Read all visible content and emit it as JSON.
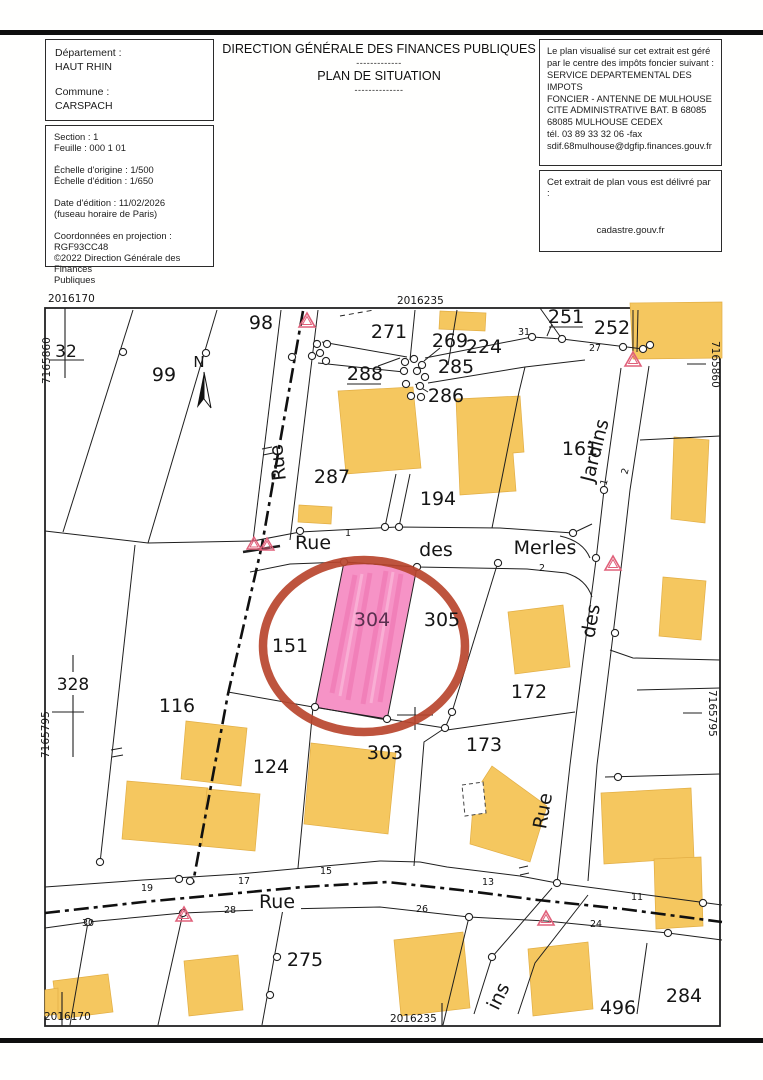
{
  "header": {
    "box1": {
      "lines": [
        "Département :",
        "HAUT RHIN",
        "",
        "Commune :",
        "CARSPACH"
      ]
    },
    "title": {
      "line1": "DIRECTION GÉNÉRALE DES FINANCES PUBLIQUES",
      "sep1": "-------------",
      "line2": "PLAN DE SITUATION",
      "sep2": "--------------"
    },
    "box2": {
      "lines": [
        "Section : 1",
        "Feuille : 000 1 01",
        "",
        "Échelle d'origine : 1/500",
        "Échelle d'édition : 1/650",
        "",
        "Date d'édition : 11/02/2026",
        "(fuseau horaire de Paris)",
        "",
        "Coordonnées en projection : RGF93CC48",
        "©2022 Direction Générale des Finances",
        "Publiques"
      ]
    },
    "box3": {
      "lines": [
        "Le plan visualisé sur cet extrait est géré",
        "par le centre des impôts foncier suivant :",
        "SERVICE DEPARTEMENTAL DES",
        "IMPOTS",
        " FONCIER - ANTENNE DE MULHOUSE",
        "CITE ADMINISTRATIVE   BAT. B 68085",
        "68085    MULHOUSE CEDEX",
        "tél.   03 89 33 32 06 -fax",
        "sdif.68mulhouse@dgfip.finances.gouv.fr"
      ]
    },
    "box4": {
      "title": "Cet extrait de plan vous est délivré par :",
      "site": "cadastre.gouv.fr"
    }
  },
  "map": {
    "corner_coords": {
      "top_left": "2016170",
      "top_center": "2016235",
      "bottom_left": "2016170",
      "bottom_center": "2016235",
      "left_top": "7165860",
      "left_bottom": "7165795",
      "right_top": "7165860",
      "right_bottom": "7165795"
    },
    "north_label": "N",
    "highlighted_parcel": "304",
    "parcels": [
      {
        "label": "98"
      },
      {
        "label": "99"
      },
      {
        "label": "271"
      },
      {
        "label": "269"
      },
      {
        "label": "224"
      },
      {
        "label": "251"
      },
      {
        "label": "252"
      },
      {
        "label": "288"
      },
      {
        "label": "285"
      },
      {
        "label": "286"
      },
      {
        "label": "287"
      },
      {
        "label": "194"
      },
      {
        "label": "161"
      },
      {
        "label": "32"
      },
      {
        "label": "328"
      },
      {
        "label": "116"
      },
      {
        "label": "151"
      },
      {
        "label": "304"
      },
      {
        "label": "305"
      },
      {
        "label": "172"
      },
      {
        "label": "173"
      },
      {
        "label": "124"
      },
      {
        "label": "303"
      },
      {
        "label": "275"
      },
      {
        "label": "496"
      },
      {
        "label": "284"
      }
    ],
    "streets": [
      {
        "label": "Rue"
      },
      {
        "label": "Rue"
      },
      {
        "label": "des"
      },
      {
        "label": "Merles"
      },
      {
        "label": "Jardins"
      },
      {
        "label": "des"
      },
      {
        "label": "Rue"
      },
      {
        "label": "Rue"
      },
      {
        "label": "ins"
      }
    ],
    "house_numbers": [
      {
        "label": "31"
      },
      {
        "label": "27"
      },
      {
        "label": "1"
      },
      {
        "label": "2"
      },
      {
        "label": "2"
      },
      {
        "label": "1"
      },
      {
        "label": "19"
      },
      {
        "label": "17"
      },
      {
        "label": "15"
      },
      {
        "label": "13"
      },
      {
        "label": "11"
      },
      {
        "label": "30"
      },
      {
        "label": "28"
      },
      {
        "label": "26"
      },
      {
        "label": "24"
      }
    ],
    "colors": {
      "building": "#f5c75f",
      "parcel_highlight": "#f693c6",
      "annotation_circle": "#b9452e",
      "warning_triangle": "#e0607a"
    }
  }
}
